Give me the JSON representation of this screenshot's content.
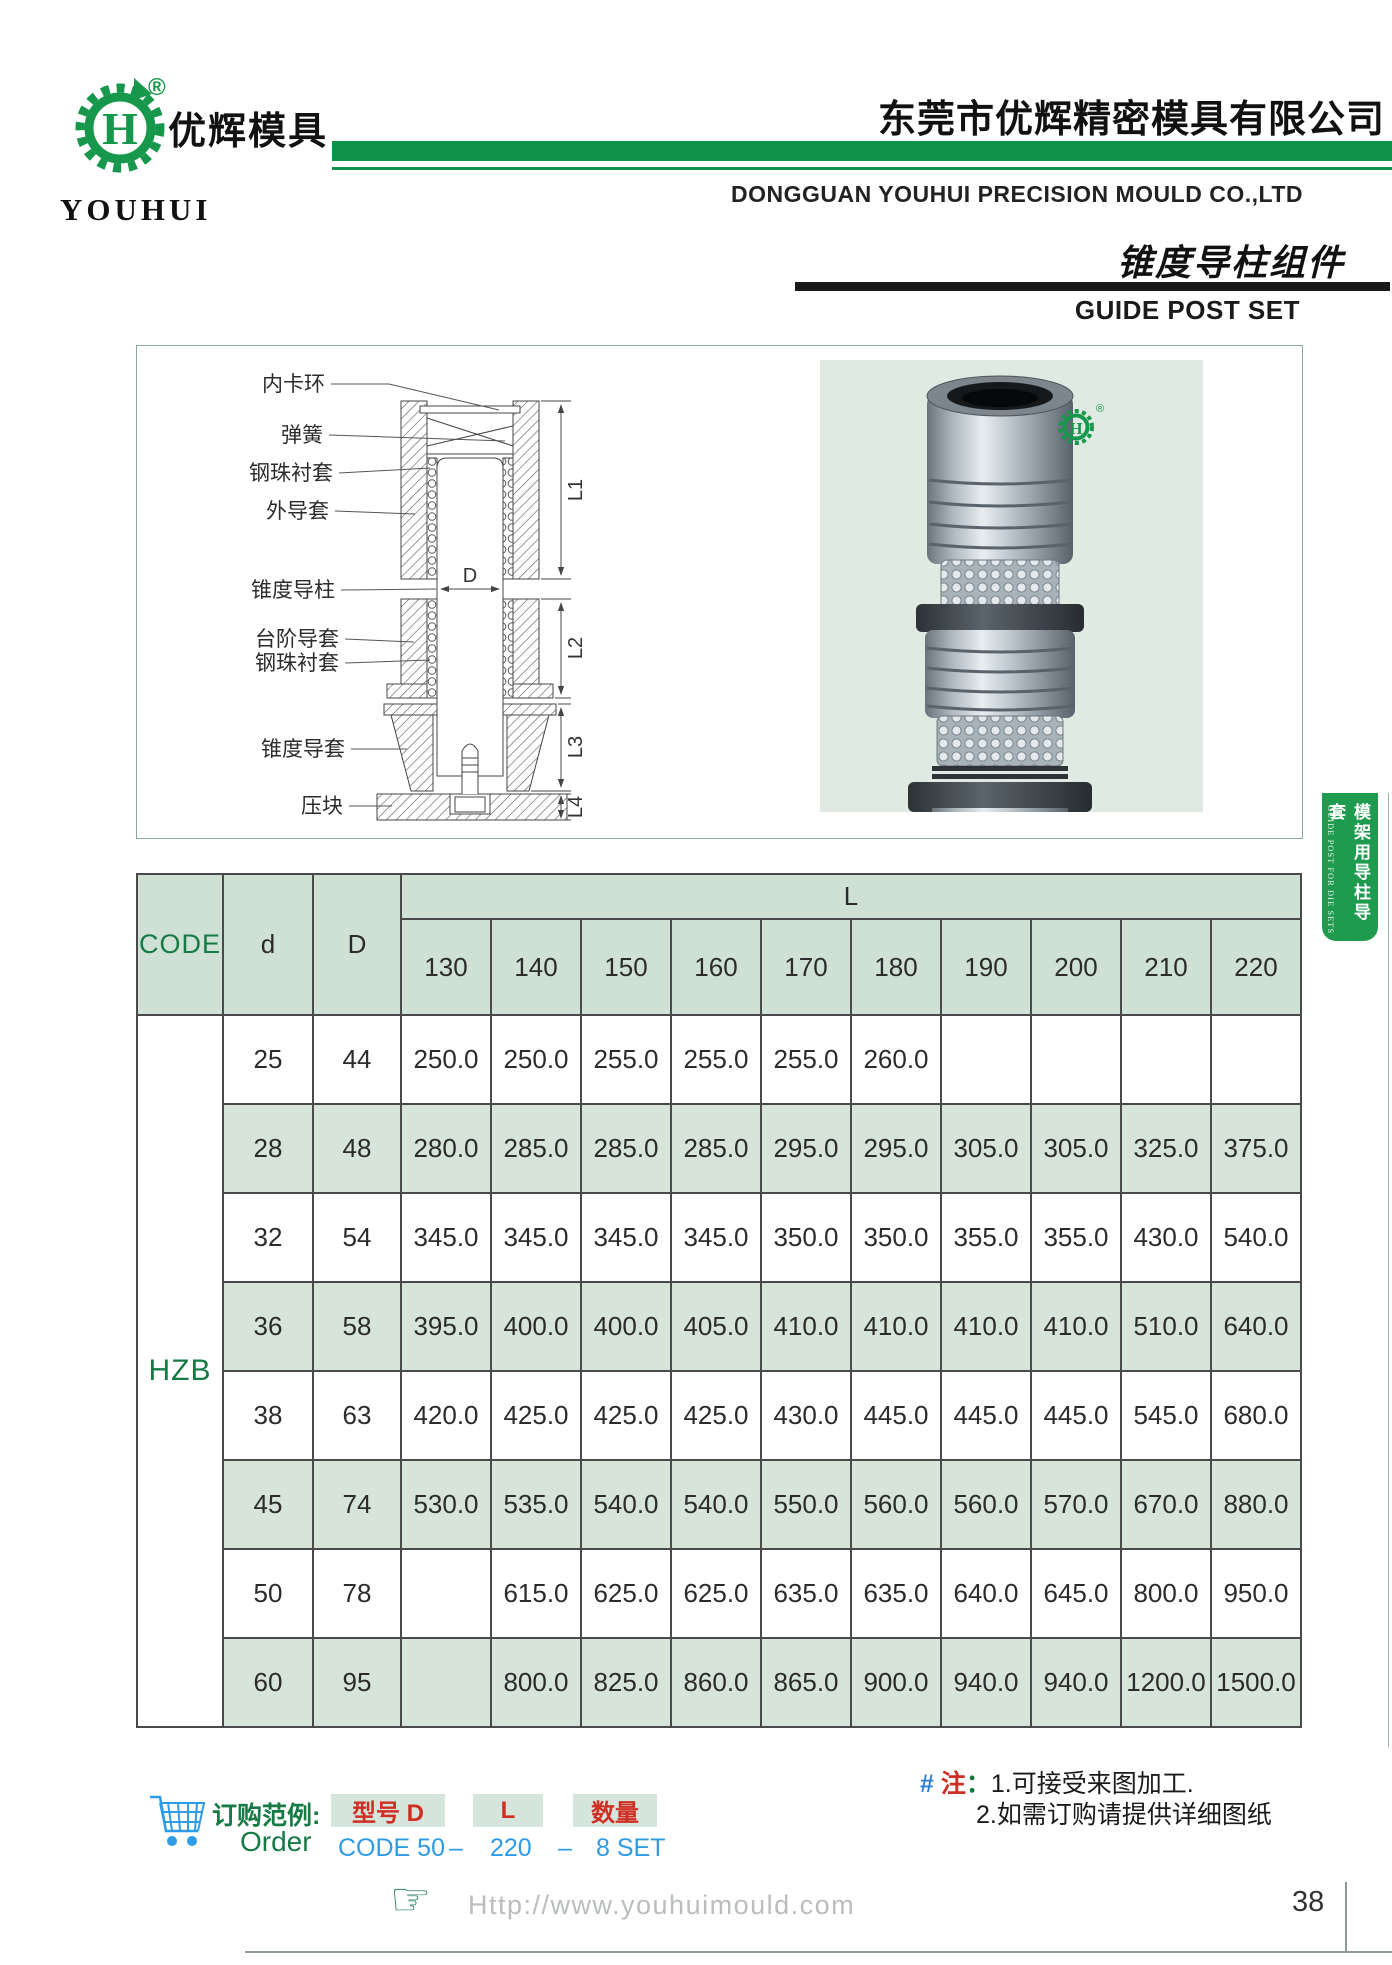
{
  "header": {
    "logo_text_cn": "优辉模具",
    "logo_text_en": "YOUHUI",
    "logo_letter": "H",
    "registered_mark": "®",
    "company_cn": "东莞市优辉精密模具有限公司",
    "company_en": "DONGGUAN YOUHUI PRECISION MOULD CO.,LTD",
    "product_title_cn": "锥度导柱组件",
    "product_title_en": "GUIDE POST SET"
  },
  "side_tab": {
    "label_cn": "模架用导柱导套",
    "label_en": "GUIDE POST FOR DIE SETS"
  },
  "diagram": {
    "labels": [
      "内卡环",
      "弹簧",
      "钢珠衬套",
      "外导套",
      "锥度导柱",
      "台阶导套",
      "钢珠衬套",
      "锥度导套",
      "压块"
    ],
    "dims": {
      "l1": "L1",
      "l2": "L2",
      "l3": "L3",
      "l4": "L4",
      "d": "D"
    }
  },
  "table": {
    "code_header": "CODE",
    "d_header": "d",
    "D_header": "D",
    "l_header": "L",
    "code_value": "HZB",
    "l_columns": [
      "130",
      "140",
      "150",
      "160",
      "170",
      "180",
      "190",
      "200",
      "210",
      "220"
    ],
    "rows": [
      {
        "d": "25",
        "D": "44",
        "values": [
          "250.0",
          "250.0",
          "255.0",
          "255.0",
          "255.0",
          "260.0",
          "",
          "",
          "",
          ""
        ]
      },
      {
        "d": "28",
        "D": "48",
        "values": [
          "280.0",
          "285.0",
          "285.0",
          "285.0",
          "295.0",
          "295.0",
          "305.0",
          "305.0",
          "325.0",
          "375.0"
        ]
      },
      {
        "d": "32",
        "D": "54",
        "values": [
          "345.0",
          "345.0",
          "345.0",
          "345.0",
          "350.0",
          "350.0",
          "355.0",
          "355.0",
          "430.0",
          "540.0"
        ]
      },
      {
        "d": "36",
        "D": "58",
        "values": [
          "395.0",
          "400.0",
          "400.0",
          "405.0",
          "410.0",
          "410.0",
          "410.0",
          "410.0",
          "510.0",
          "640.0"
        ]
      },
      {
        "d": "38",
        "D": "63",
        "values": [
          "420.0",
          "425.0",
          "425.0",
          "425.0",
          "430.0",
          "445.0",
          "445.0",
          "445.0",
          "545.0",
          "680.0"
        ]
      },
      {
        "d": "45",
        "D": "74",
        "values": [
          "530.0",
          "535.0",
          "540.0",
          "540.0",
          "550.0",
          "560.0",
          "560.0",
          "570.0",
          "670.0",
          "880.0"
        ]
      },
      {
        "d": "50",
        "D": "78",
        "values": [
          "",
          "615.0",
          "625.0",
          "625.0",
          "635.0",
          "635.0",
          "640.0",
          "645.0",
          "800.0",
          "950.0"
        ]
      },
      {
        "d": "60",
        "D": "95",
        "values": [
          "",
          "800.0",
          "825.0",
          "860.0",
          "865.0",
          "900.0",
          "940.0",
          "940.0",
          "1200.0",
          "1500.0"
        ]
      }
    ]
  },
  "order": {
    "title_cn": "订购范例:",
    "title_en": "Order",
    "boxes": [
      "型号 D",
      "L",
      "数量"
    ],
    "example": {
      "code": "CODE 50",
      "dash1": "–",
      "l": "220",
      "dash2": "–",
      "qty": "8 SET"
    }
  },
  "note": {
    "hash": "#",
    "mark": "注",
    "colon": "：",
    "line1": "1.可接受来图加工.",
    "line2": "2.如需订购请提供详细图纸"
  },
  "footer": {
    "website": "Http://www.youhuimould.com",
    "page_number": "38"
  },
  "colors": {
    "brand_green": "#0e9149",
    "tab_green": "#1f9b4f",
    "cell_green": "#d6e4da",
    "red": "#cf2e24",
    "blue": "#2e9be6",
    "photo_bg": "#dfeae3"
  }
}
